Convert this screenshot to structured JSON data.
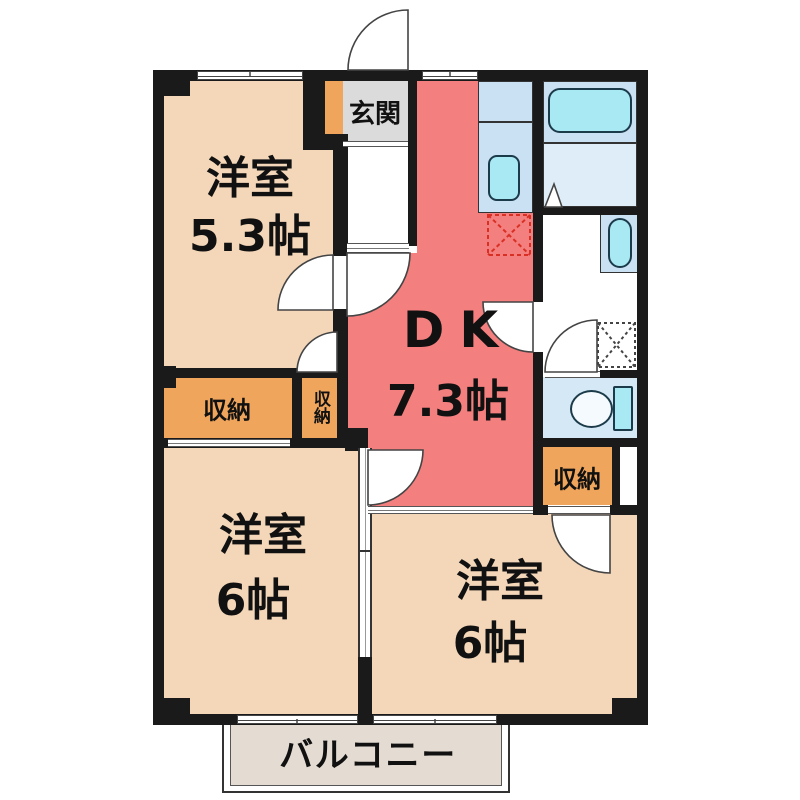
{
  "rooms": [
    {
      "name": "洋室",
      "size": "5.3帖"
    },
    {
      "name": "DK",
      "size": "7.3帖"
    },
    {
      "name": "洋室",
      "size": "6帖"
    },
    {
      "name": "洋室",
      "size": "6帖"
    }
  ],
  "entrance": {
    "label": "玄関"
  },
  "storage": {
    "wide": "収納",
    "tall": "収納",
    "right": "収納"
  },
  "balcony": {
    "label": "バルコニー"
  },
  "colors": {
    "room_floor": "#f4d7b9",
    "dk_floor": "#f47f7f",
    "storage": "#efa55c",
    "entrance_floor": "#dbdbdb",
    "wet_panel": "#c9e1f3",
    "fixture": "#a9e9f3",
    "toilet_room": "#d5e8f6",
    "balcony_floor": "#e4dcd3",
    "wall": "#1a1a1a",
    "fridge_mark": "#d93025"
  }
}
